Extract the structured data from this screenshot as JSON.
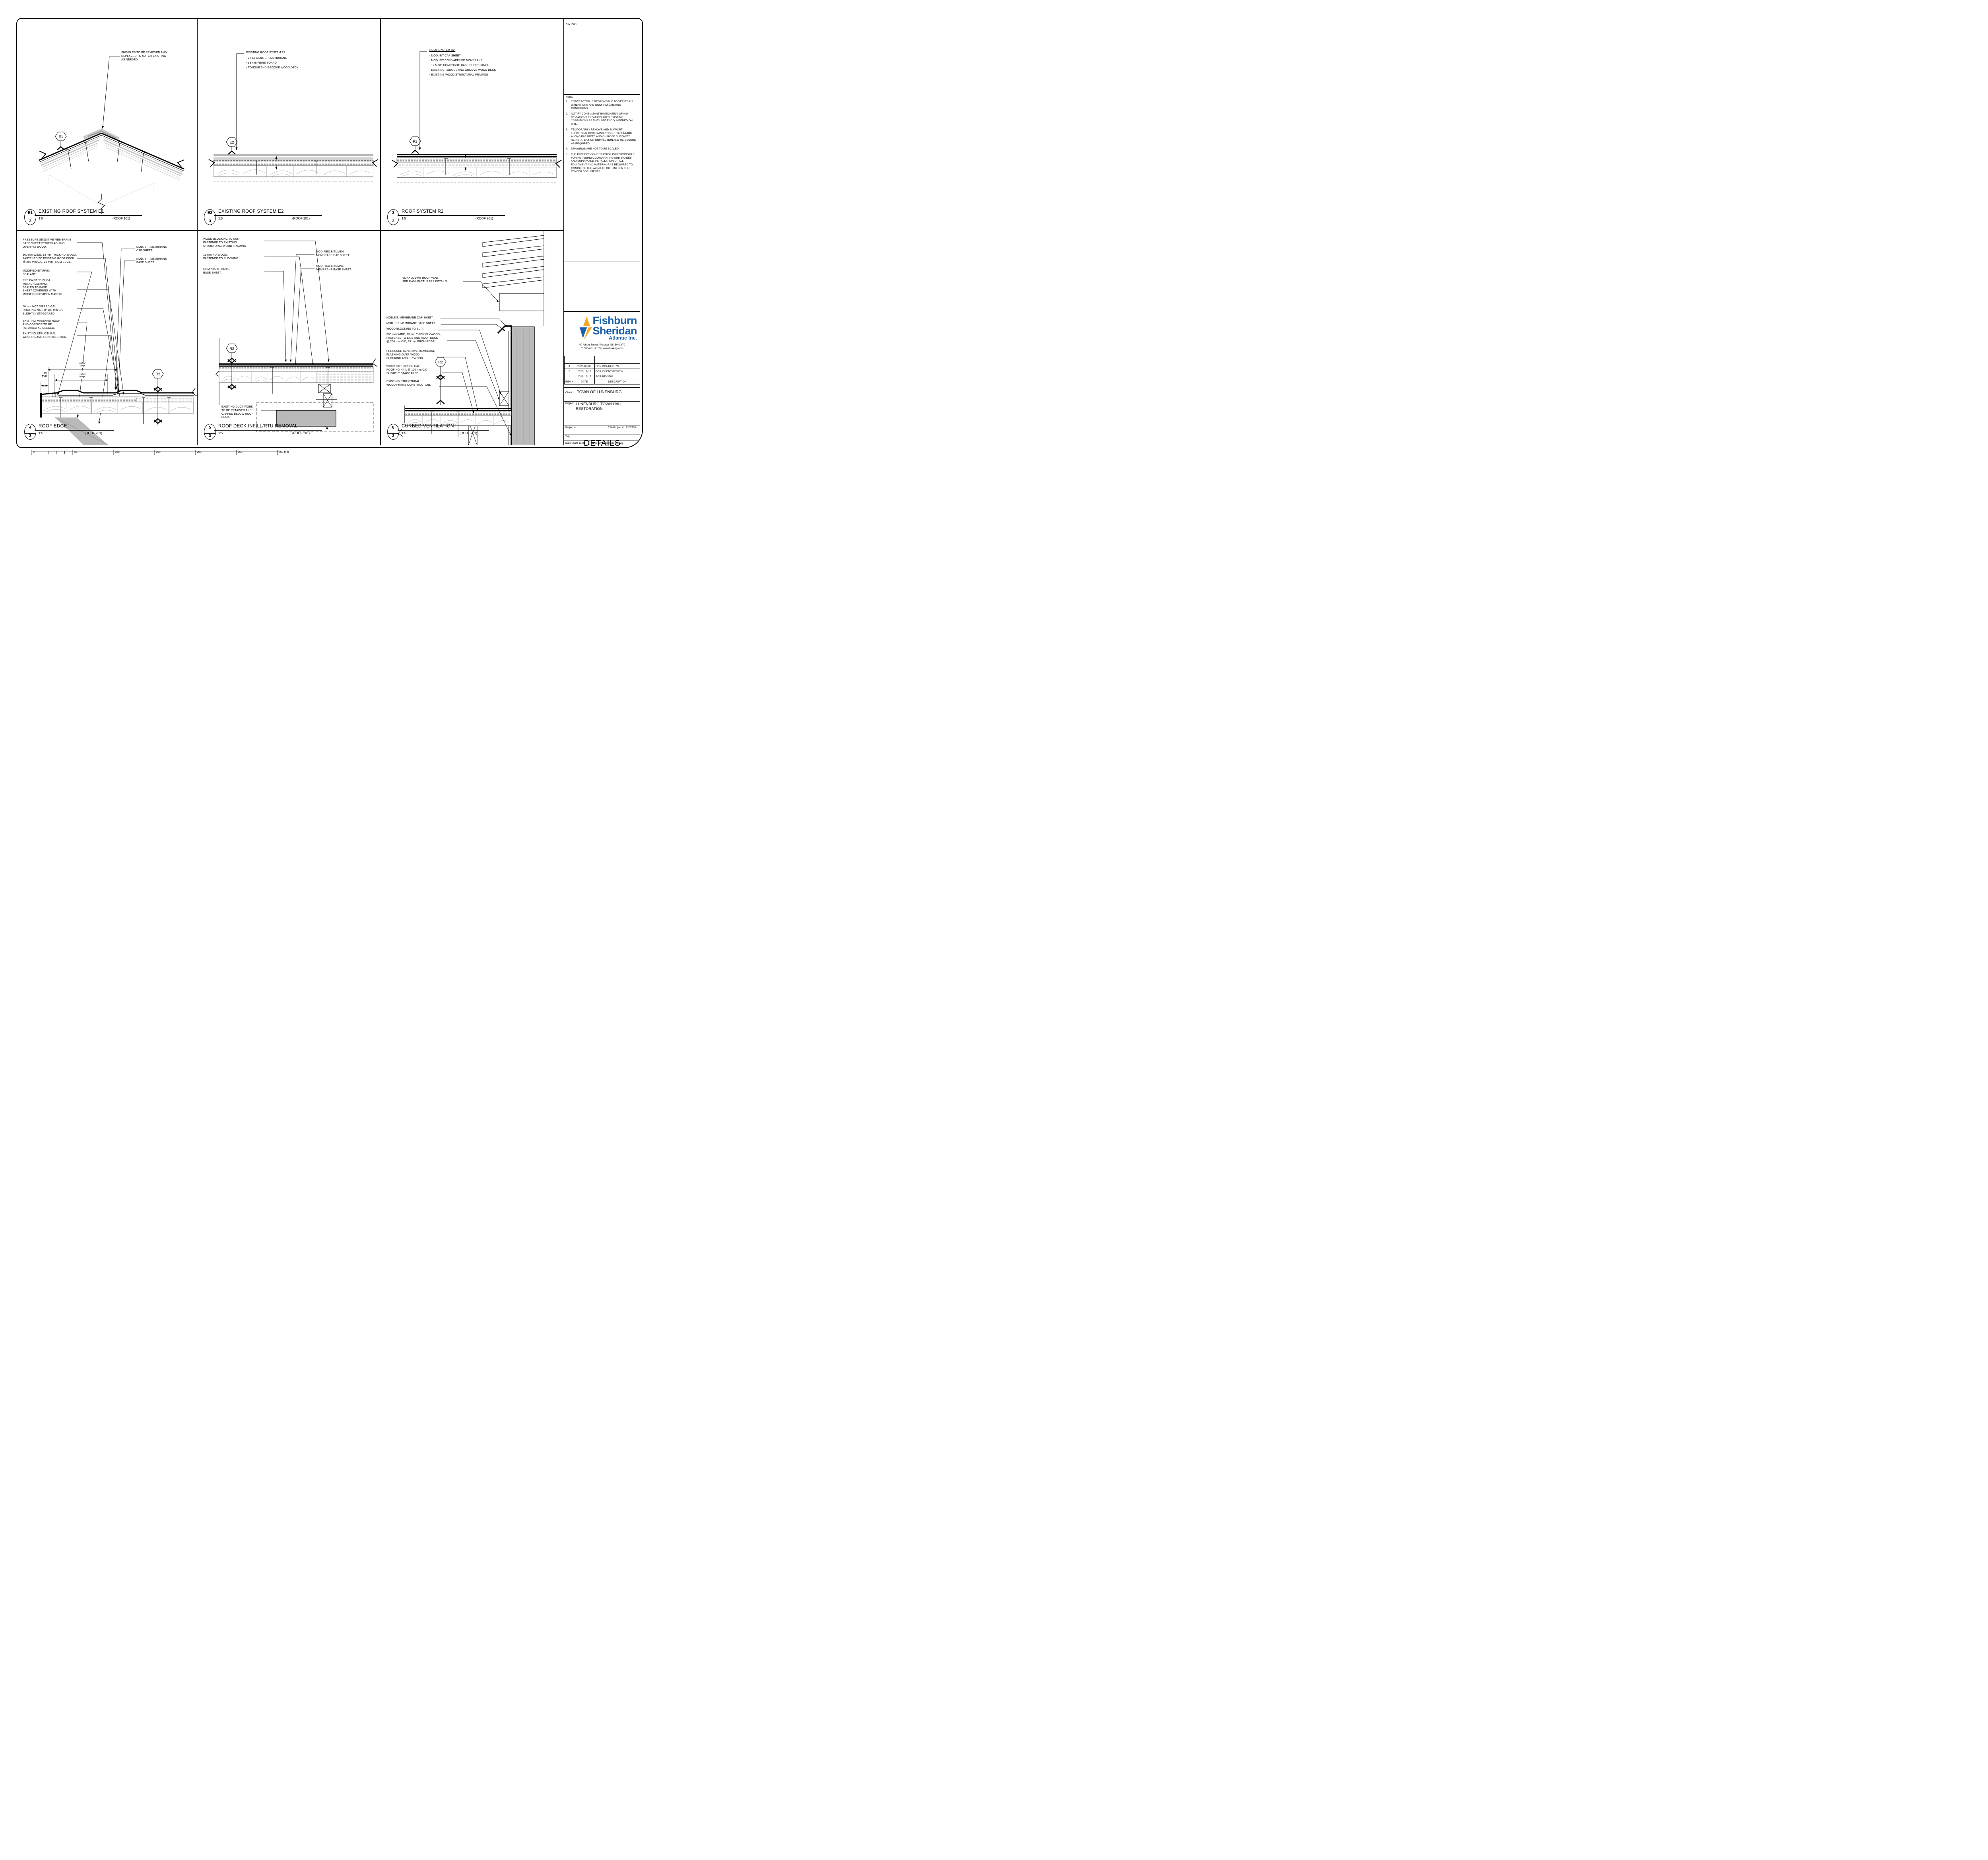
{
  "sheet": {
    "scalebar_labels": [
      "0",
      "50",
      "100",
      "150",
      "200",
      "250",
      "300 mm"
    ]
  },
  "panels": [
    {
      "tag": "E1",
      "bubble_num": "E1",
      "bubble_sheet": "3",
      "title": "EXISTING ROOF SYSTEM E1",
      "scale": "1:5",
      "ref": "(ROOF 101)",
      "callout": "SHINGLES TO BE REMOVED AND\nREPLACED TO MATCH EXISTING\nAS NEEDED."
    },
    {
      "tag": "E2",
      "bubble_num": "E2",
      "bubble_sheet": "3",
      "title": "EXISTING ROOF SYSTEM E2",
      "scale": "1:5",
      "ref": "(ROOF 201)",
      "heading": "EXISTING ROOF SYSTEM E2:",
      "items": [
        "- 2-PLY MOD. BIT. MEMBRANE",
        "- 13 mm FIBRE BOARD",
        "- TONGUE AND GROOVE WOOD DECK"
      ]
    },
    {
      "tag": "R2",
      "bubble_num": "3",
      "bubble_sheet": "3",
      "title": "ROOF SYSTEM R2",
      "scale": "1:5",
      "ref": "(ROOF 201)",
      "heading": "ROOF SYSTEM R2:",
      "items": [
        "- MOD. BIT CAP SHEET",
        "- MOD. BIT COLD APPLIED MEMBRANE",
        "- 12.5 mm COMPOSITE BASE SHEET PANEL.",
        "- EXISTING TONGUE AND GROOVE WOOD DECK",
        "- EXISTING WOOD STRUCTURAL FRAMING"
      ]
    },
    {
      "tag": "R2",
      "bubble_num": "4",
      "bubble_sheet": "3",
      "title": "ROOF EDGE",
      "scale": "1:5",
      "ref": "(ROOF 201)",
      "left_notes": [
        "PRESSURE SENSITIVE MEMBRANE\nBASE SHEET STRIP FLASHING,\nOVER PLYWOOD.",
        "300 mm WIDE, 13 mm THICK PLYWOOD,\nFASTENED TO EXISTING ROOF DECK\n@ 250 mm C/C, 25 mm FROM EDGE.",
        "MODIFIED BITUMEN\nSEALANT.",
        "PRE PAINTED 22 GA.\nMETAL FLASHING,\nSEALED TO BASE\nSHEET COVERING WITH\nMODIFIED BITUMEN MASTIC.",
        "50 mm HOT DIPPED GAL.\nROOFING NAIL @ 100 mm C/C\nSLIGHTLY STAGGARED.",
        "EXISTING MANSARD ROOF\nAND CORNICE TO BE\nREPAIRED AS NEEDED.",
        "EXISTING STRUCTURAL\nWOOD FRAME CONSTRUCTION."
      ],
      "right_notes": [
        "MOD. BIT. MEMBRANE\nCAP SHEET.",
        "MOD. BIT. MEMBRANE\nBASE SHEET."
      ],
      "dims": {
        "d25": "±25\nTYP.",
        "d300": "±300\nTYP.",
        "d250": "±250\nTYP."
      }
    },
    {
      "tag": "R2",
      "bubble_num": "5",
      "bubble_sheet": "3",
      "title": "ROOF DECK INFILL/RTU REMOVAL",
      "scale": "1:5",
      "ref": "(ROOF 201)",
      "left_notes": [
        "WOOD BLOCKING TO SUIT,\nFASTENED TO EXISTING\nSTRUCTURAL WOOD FRAMING.",
        "19 mm PLYWOOD,\nFASTENED TO BLOCKING.",
        "COMPOSITE PANEL\nBASE SHEET."
      ],
      "duct_note": "EXISTING DUCT WORK\nTO BE RETAINED AND\nCAPPED BELOW ROOF\nDECK.",
      "right_notes": [
        "MODIFIED BITUMEN\nMEMBRANE CAP SHEET.",
        "MODIFIED BITUMNE\nMEMBRANE BASE SHEET."
      ]
    },
    {
      "tag": "R2",
      "bubble_num": "6",
      "bubble_sheet": "3",
      "title": "CURBED VENTILATION",
      "scale": "1:5",
      "ref": "(ROOF 201)",
      "vent_note": "VMAX 201-MB ROOF VENT.\nSEE MANUFACTURERS DETAILS.",
      "left_notes": [
        "MOD.BIT. MEMBRANE CAP SHEET.",
        "MOD. BIT. MEMBRANE BASE SHEET.",
        "WOOD BLOCKING TO SUIT.",
        "300 mm WIDE, 13 mm THICK PLYWOOD,\nFASTENED TO EXISTING ROOF DECK\n@ 250 mm C/C, 25 mm FROM EDGE.",
        "PRESSURE SENSITIVE MEMBRANE\nFLASHING OVER WOOD\nBLOCKING AND PLYWOOD.",
        "50 mm HOT DIPPED GAL.\nROOFING NAIL @ 100 mm C/C\nSLIGHTLY STAGGARED.",
        "EXISTING STRUCTURAL\nWOOD FRAME CONSTRUCTION."
      ]
    }
  ],
  "sidebar": {
    "keyplan_label": "Key Plan:",
    "notes_label": "Notes:",
    "notes": [
      {
        "num": "1.",
        "text": "CONTRACTOR IS RESPONSIBLE TO VERIFY ALL DIMENSIONS AND CONFIRM EXISTING CONDITIONS."
      },
      {
        "num": "2.",
        "text": "NOTIFY CONSULTANT IMMEDIATELY OF ANY DEVIATIONS FROM ASSUMED EXISTING CONDITIONS AS THEY ARE ENCOUNTERED ON SITE."
      },
      {
        "num": "3.",
        "text": "TEMPORARILY REMOVE AND SUPPORT ELECTRICAL BOXES AND CONDUITS RUNNING ALONG PARAPETS AND ON ROOF SURFACES.  REINSTATE UPON COMPLETION AND RE-SECURE AS REQUIRED."
      },
      {
        "num": "4.",
        "text": "DRAWINGS ARE NOT TO BE SCALED."
      },
      {
        "num": "5.",
        "text": "THE PROJECT CONSTRUCTOR IS RESPONSIBLE FOR RETAINING/COORDINATING SUB-TRADES, AND SUPPLY AND INSTALLATION OF ALL EQUIPMENT AND MATERIALS AS REQUIRED TO COMPLETE THE WORK AS OUTLINED IN THE TENDER DOCUMENTS."
      }
    ],
    "logo": {
      "word1": "Fishburn",
      "word2": "Sheridan",
      "word3": "Atlantic Inc.",
      "address": "40 Albert Street, Windsor NS B0N 2T0",
      "phone": "T: 506-651-9159 | www.fsaeng.com",
      "brand_blue": "#1b5fa8",
      "brand_yellow": "#f6a823"
    },
    "revisions": {
      "headers": [
        "REV #",
        "DATE",
        "DESCRIPTION"
      ],
      "rows": [
        {
          "rev": "3",
          "date": "2025-08-06",
          "desc": "FOR 99% REVIEW"
        },
        {
          "rev": "2",
          "date": "2023-12-19",
          "desc": "FOR CLIENT REVIEW"
        },
        {
          "rev": "1",
          "date": "2023-12-15",
          "desc": "FOR REVIEW"
        }
      ]
    },
    "client_label": "Client:",
    "client": "TOWN OF LUNENBURG",
    "project_label": "Project:",
    "project": "LUNENBURG TOWN HALL\nRESTORATION",
    "projnum_label": "Project #:",
    "fsa_label": "FSA Project #:",
    "fsa_value": "22057DA",
    "title_label": "Title:",
    "sheet_title": "DETAILS",
    "address_label": "Address of Project:",
    "address1": "119 CUMBERLAND ST",
    "address2": "LUNENBURG, NS",
    "scale_cell": "Scale:  (1:5)",
    "drw_cell": "Drw.:  MAN",
    "dgn_cell": "Dgn.:  MAN/GH",
    "chk_cell": "Chk.:  GH",
    "page_label": "Page Number:",
    "page_number": "3",
    "date_label": "Date:  2023-11-28",
    "file_name": "22057DA-Drawings-01.dwg"
  }
}
